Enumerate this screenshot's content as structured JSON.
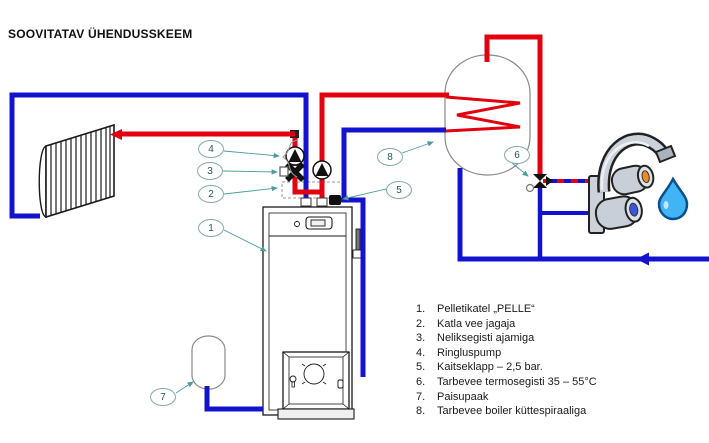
{
  "title": "SOOVITATAV ÜHENDUSSKEEM",
  "legend": {
    "items": [
      {
        "num": "1.",
        "text": "Pelletikatel „PELLE“"
      },
      {
        "num": "2.",
        "text": "Katla vee jagaja"
      },
      {
        "num": "3.",
        "text": "Neliksegisti ajamiga"
      },
      {
        "num": "4.",
        "text": "Ringluspump"
      },
      {
        "num": "5.",
        "text": "Kaitseklapp – 2,5 bar."
      },
      {
        "num": "6.",
        "text": "Tarbevee termosegisti 35 – 55°C"
      },
      {
        "num": "7.",
        "text": "Paisupaak"
      },
      {
        "num": "8.",
        "text": "Tarbevee boiler küttespiraaliga"
      }
    ]
  },
  "callouts": [
    {
      "label": "1"
    },
    {
      "label": "2"
    },
    {
      "label": "3"
    },
    {
      "label": "4"
    },
    {
      "label": "5"
    },
    {
      "label": "6"
    },
    {
      "label": "7"
    },
    {
      "label": "8"
    }
  ],
  "colors": {
    "hot_pipe": "#e3000f",
    "cold_pipe": "#1313cf",
    "mixed_water": "dashed red over blue",
    "callout_stroke": "#85abab",
    "callout_text": "#215a5a",
    "leader_line": "#4d9d9d",
    "device_outline": "#1a1a1a"
  }
}
